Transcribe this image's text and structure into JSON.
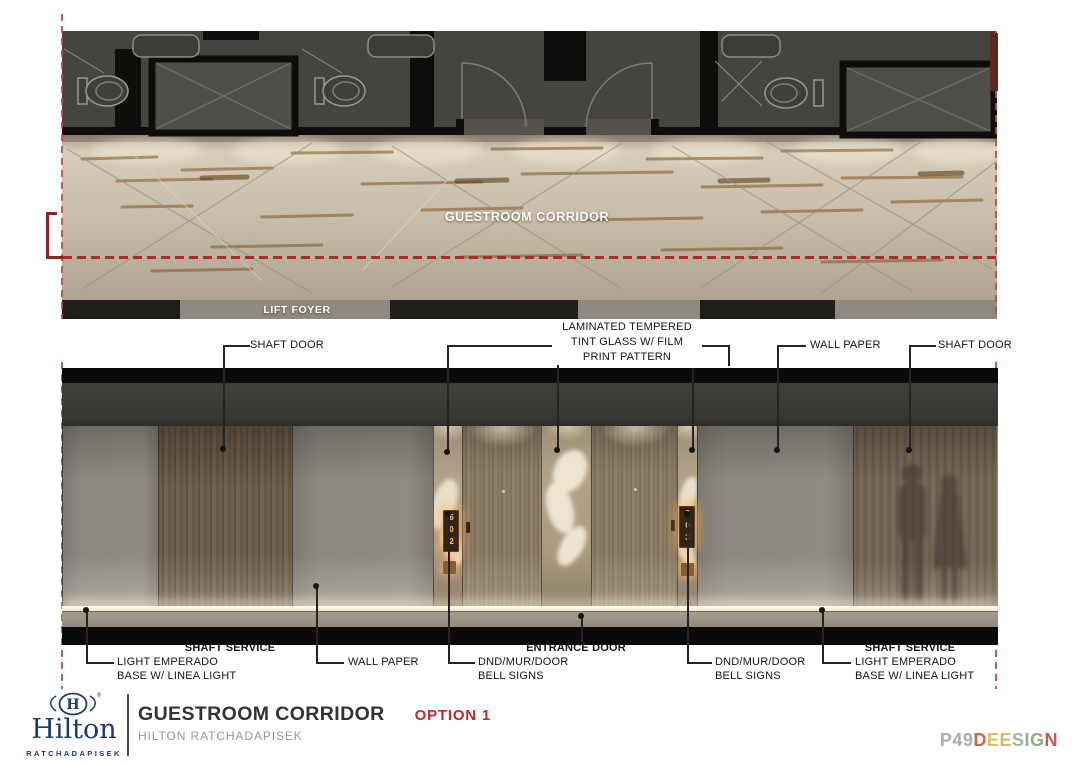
{
  "palette": {
    "annotation_red": "#ad292c",
    "bracket_dark_red": "#8c2424",
    "hilton_navy": "#1c3a6d",
    "option_red": "#c1272d",
    "sign_glow_amber": "#ffc06a",
    "marble_beige": "#c8bcaa",
    "wall_gray": "#8d8881",
    "wood_brown": "#6d5e4d"
  },
  "plan": {
    "corridor_label": "GUESTROOM CORRIDOR",
    "lift_foyer_label": "LIFT FOYER"
  },
  "elevation": {
    "room_sign_left": "602",
    "room_sign_right": "603"
  },
  "callouts": {
    "top": [
      {
        "label": "SHAFT DOOR"
      },
      {
        "lines": [
          "LAMINATED TEMPERED",
          "TINT GLASS W/ FILM",
          "PRINT PATTERN"
        ]
      },
      {
        "label": "WALL PAPER"
      },
      {
        "label": "SHAFT DOOR"
      }
    ],
    "bottom": [
      {
        "title": "SHAFT SERVICE",
        "line1": "LIGHT EMPERADO",
        "line2": "BASE W/ LINEA LIGHT"
      },
      {
        "label": "WALL PAPER"
      },
      {
        "title": "ENTRANCE DOOR"
      },
      {
        "line1": "DND/MUR/DOOR",
        "line2": "BELL SIGNS"
      },
      {
        "line1": "DND/MUR/DOOR",
        "line2": "BELL SIGNS"
      },
      {
        "title": "SHAFT SERVICE",
        "line1": "LIGHT EMPERADO",
        "line2": "BASE W/ LINEA LIGHT"
      }
    ]
  },
  "footer": {
    "brand": "Hilton",
    "brand_mark": "H",
    "registered": "®",
    "brand_sub": "RATCHADAPISEK",
    "title": "GUESTROOM CORRIDOR",
    "option": "OPTION 1",
    "subtitle": "HILTON RATCHADAPISEK",
    "studio_letters": [
      {
        "char": "P",
        "color": "#a9aeae"
      },
      {
        "char": "4",
        "color": "#a9aeae"
      },
      {
        "char": "9",
        "color": "#a9aeae"
      },
      {
        "char": "D",
        "color": "#d2624f"
      },
      {
        "char": "E",
        "color": "#d9c35a"
      },
      {
        "char": "E",
        "color": "#cdbd6e"
      },
      {
        "char": "S",
        "color": "#a8b39f"
      },
      {
        "char": "I",
        "color": "#9aa795"
      },
      {
        "char": "G",
        "color": "#8fae77"
      },
      {
        "char": "N",
        "color": "#c95a4f"
      }
    ]
  }
}
